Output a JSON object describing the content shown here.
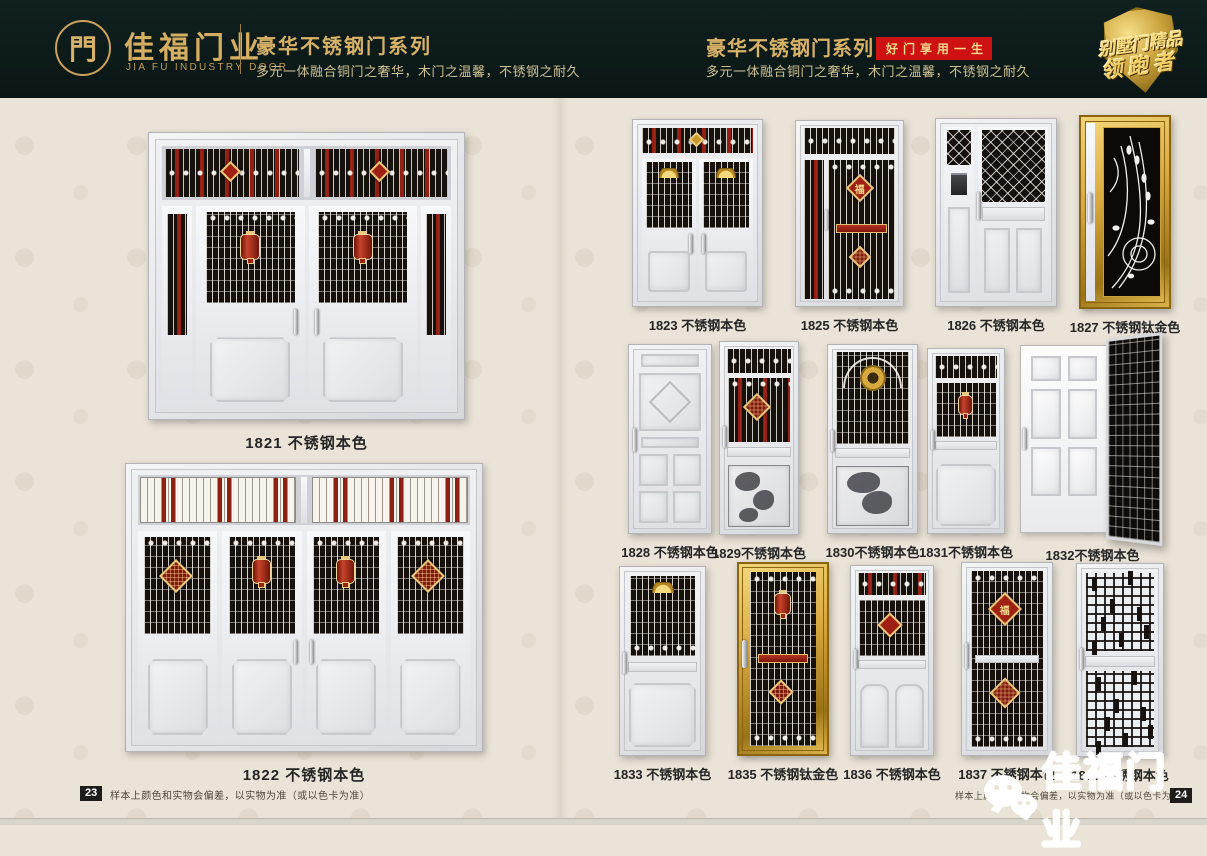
{
  "header": {
    "brand": {
      "logo_char": "門",
      "name": "佳福门业",
      "name_en": "JIA FU INDUSTRY DOOR"
    },
    "left_series": {
      "title": "豪华不锈钢门系列",
      "subtitle": "多元一体融合铜门之奢华，木门之温馨，不锈钢之耐久"
    },
    "right_series": {
      "title": "豪华不锈钢门系列",
      "badge": "好门享用一生",
      "subtitle": "多元一体融合铜门之奢华，木门之温馨，不锈钢之耐久"
    },
    "shield_badge": {
      "line1": "别墅门精品",
      "line2": "领跑者"
    }
  },
  "left_page": {
    "products": [
      {
        "id": "1821",
        "label": "1821 不锈钢本色"
      },
      {
        "id": "1822",
        "label": "1822 不锈钢本色"
      }
    ],
    "footer": {
      "page_number": "23",
      "disclaimer": "样本上颜色和实物会偏差，以实物为准（或以色卡为准）"
    }
  },
  "right_page": {
    "row1": [
      {
        "id": "1823",
        "label": "1823 不锈钢本色"
      },
      {
        "id": "1825",
        "label": "1825 不锈钢本色"
      },
      {
        "id": "1826",
        "label": "1826 不锈钢本色"
      },
      {
        "id": "1827",
        "label": "1827 不锈钢钛金色"
      }
    ],
    "row2": [
      {
        "id": "1828",
        "label": "1828 不锈钢本色"
      },
      {
        "id": "1829",
        "label": "1829不锈钢本色"
      },
      {
        "id": "1830",
        "label": "1830不锈钢本色"
      },
      {
        "id": "1831",
        "label": "1831不锈钢本色"
      },
      {
        "id": "1832",
        "label": "1832不锈钢本色"
      }
    ],
    "row3": [
      {
        "id": "1833",
        "label": "1833 不锈钢本色"
      },
      {
        "id": "1835",
        "label": "1835 不锈钢钛金色"
      },
      {
        "id": "1836",
        "label": "1836 不锈钢本色"
      },
      {
        "id": "1837",
        "label": "1837 不锈钢本色"
      },
      {
        "id": "1838",
        "label": "1838 不锈钢本色"
      }
    ],
    "watermark": {
      "icon": "wechat-icon",
      "text": "佳福门业"
    },
    "footer": {
      "page_number": "24",
      "disclaimer": "样本上颜色和实物会偏差，以实物为准（或以色卡为准）"
    }
  },
  "decor": {
    "fu": "福"
  },
  "colors": {
    "header_bg": "#0c1b19",
    "brand_gold": "#d6ae62",
    "badge_red": "#ce1212",
    "paper_beige": "#eae4d8",
    "grille_black": "#17110e",
    "ornament_red": "#9a2214",
    "titanium_gold": "#daa93e",
    "steel_silver": "#e7e8ec"
  }
}
